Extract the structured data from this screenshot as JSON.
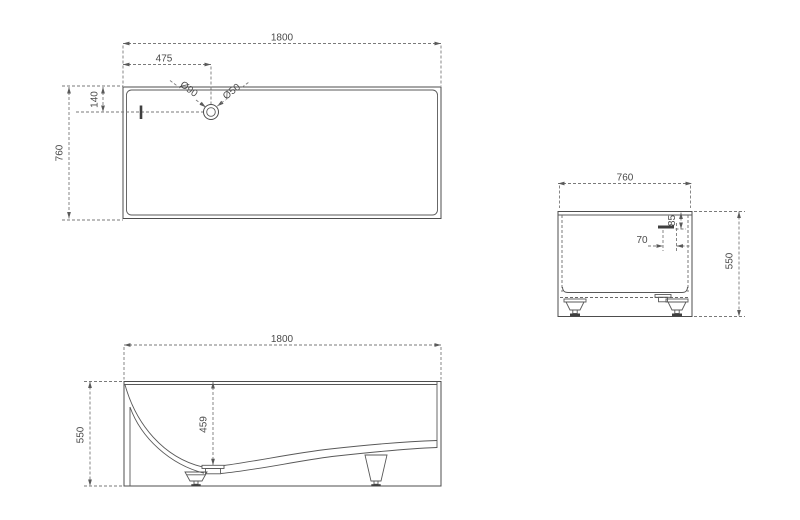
{
  "background": "#ffffff",
  "colors": {
    "geometry_line": "#4d4d4d",
    "dimension_line": "#7a7a7a",
    "text": "#4a4a4a"
  },
  "views": {
    "plan": {
      "dims": {
        "length": "1800",
        "drain_offset_x": "475",
        "drain_offset_y": "140",
        "width": "760",
        "drain_outer_dia": "Ø90",
        "drain_inner_dia": "Ø50"
      }
    },
    "side": {
      "dims": {
        "width": "760",
        "overflow_offset": "70",
        "overflow_depth": "85",
        "height": "550"
      }
    },
    "front": {
      "dims": {
        "length": "1800",
        "height": "550",
        "inner_depth": "459"
      }
    }
  }
}
